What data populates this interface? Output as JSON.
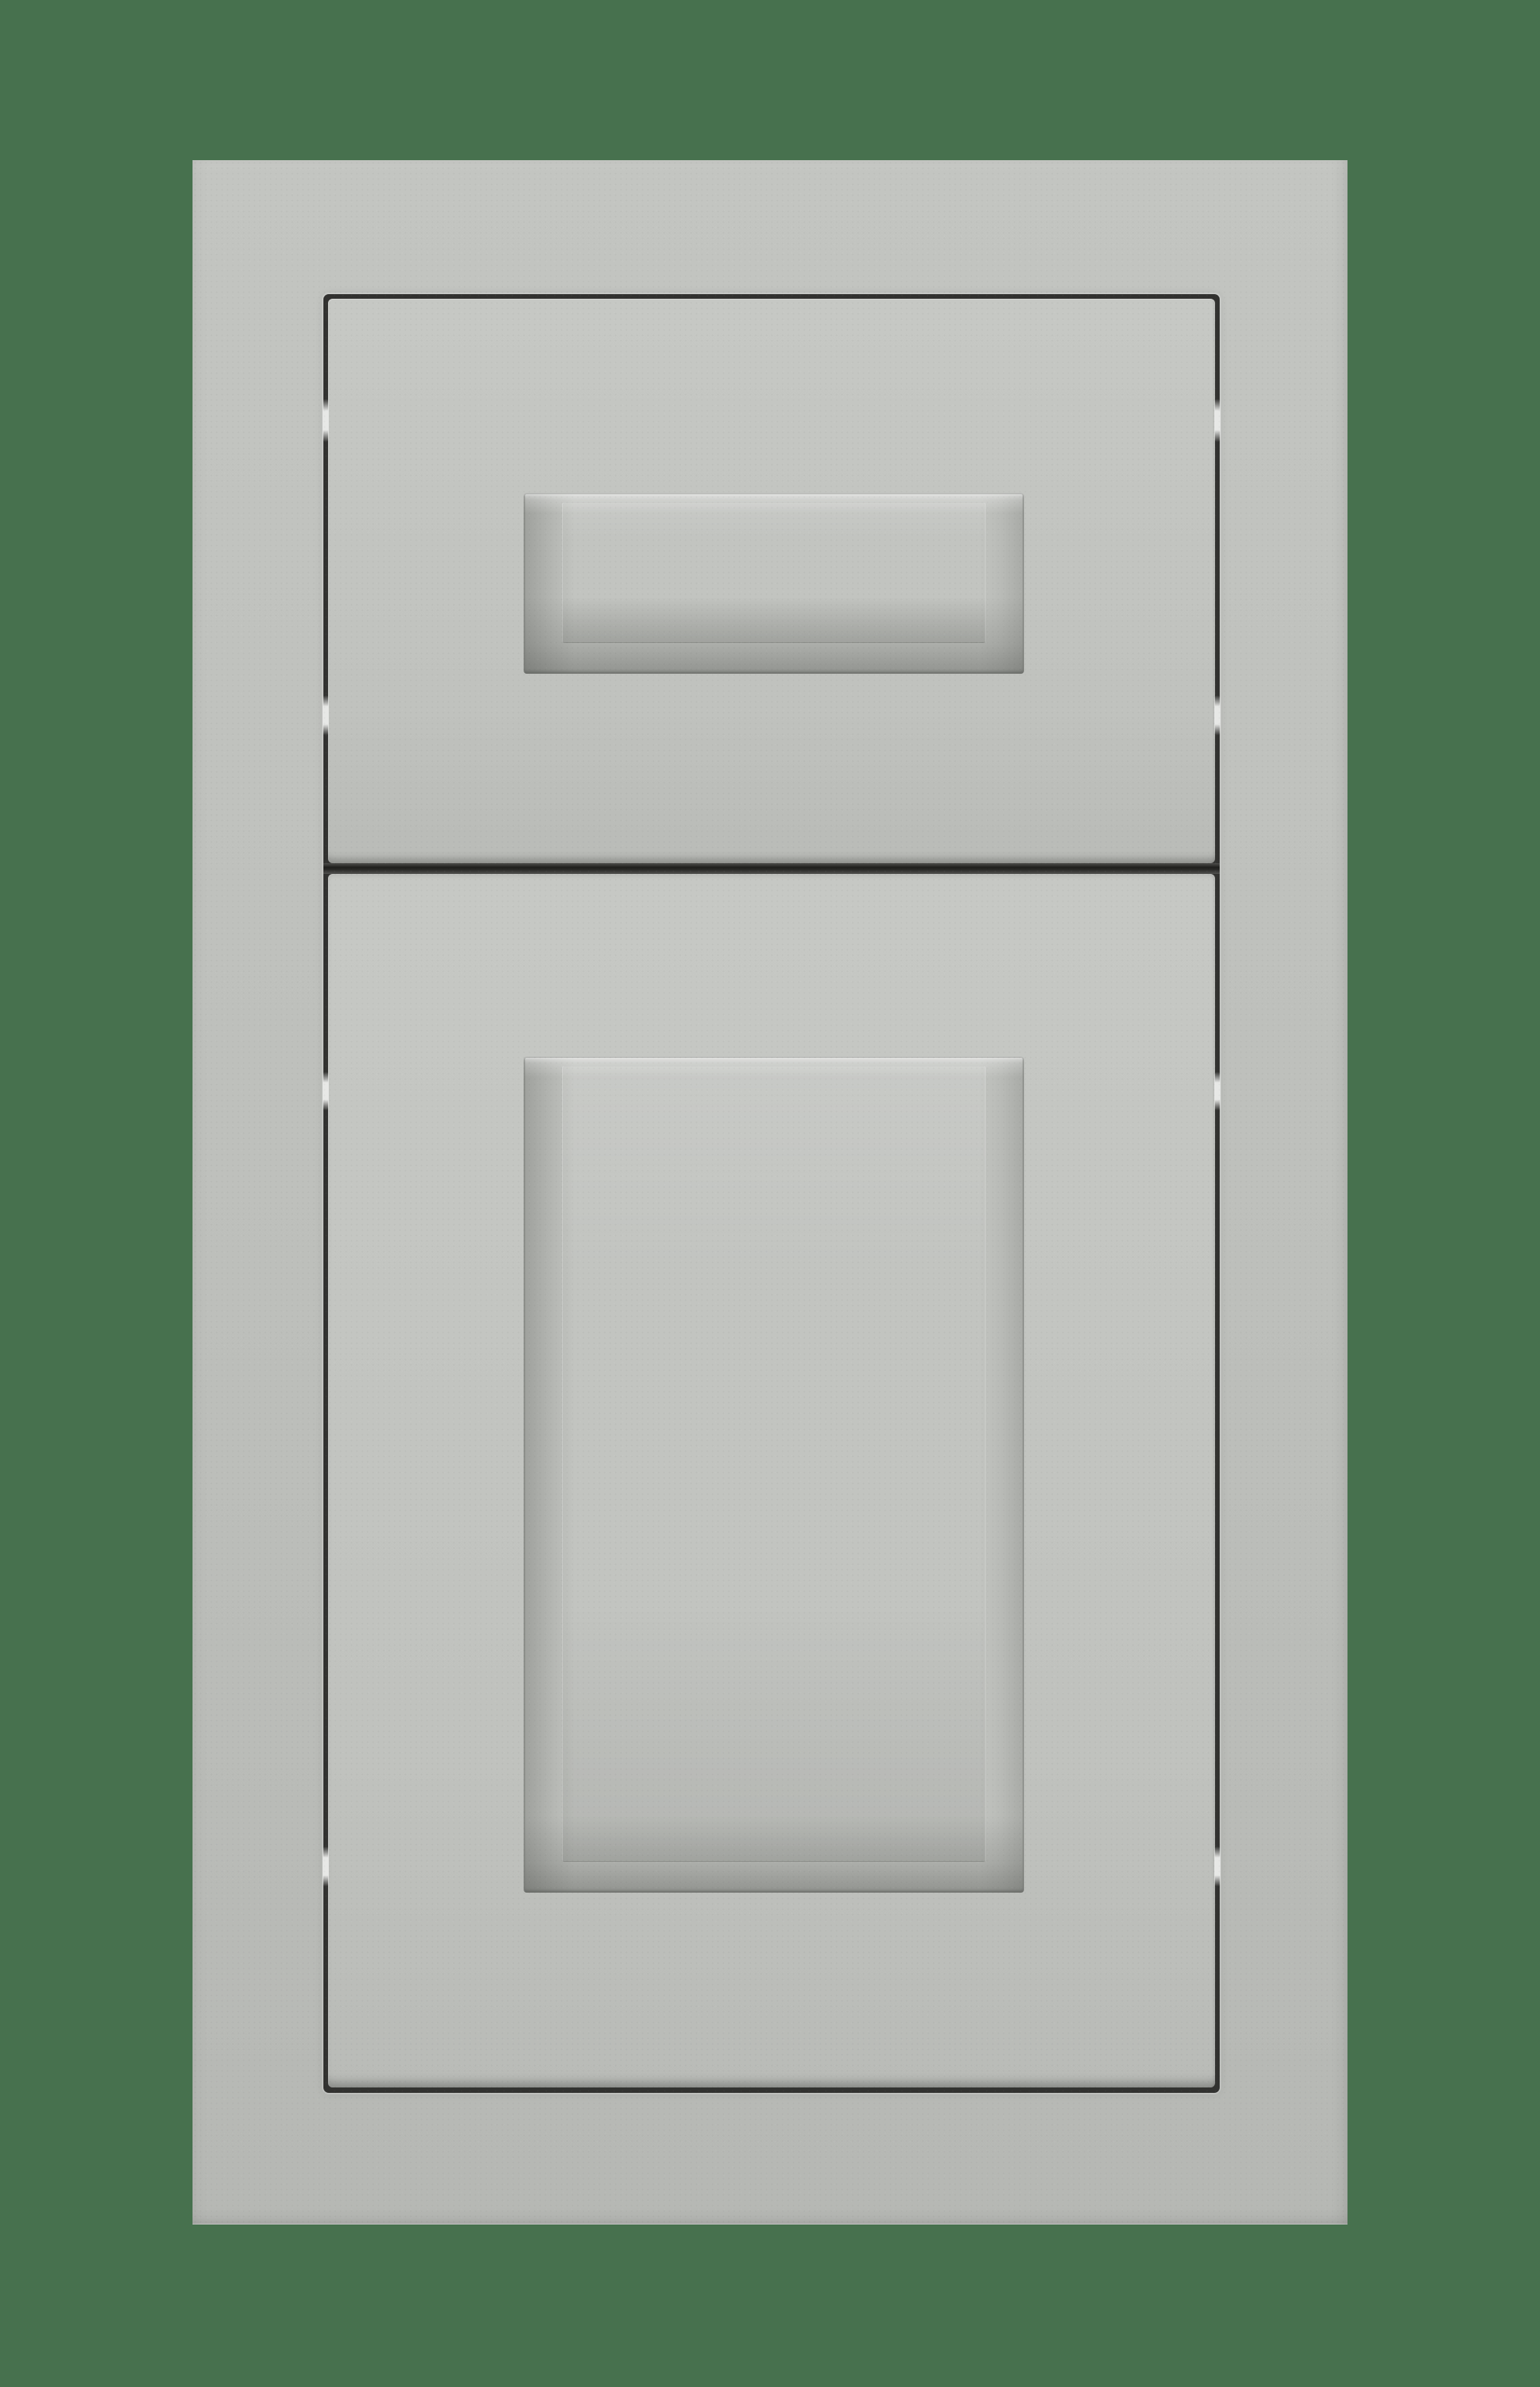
{
  "meta": {
    "subject": "Gray shaker-style cabinet sample: one drawer front above one door front mounted in a face frame, photographed on a plain green background",
    "text_content": "none"
  },
  "parts": [
    {
      "name": "background"
    },
    {
      "name": "cabinet-face-frame"
    },
    {
      "name": "frame-opening-reveal-gap"
    },
    {
      "name": "drawer-front"
    },
    {
      "name": "drawer-recessed-panel"
    },
    {
      "name": "door-front"
    },
    {
      "name": "door-recessed-panel"
    },
    {
      "name": "drawer-door-divider-gap"
    },
    {
      "name": "hinge-gap-highlights"
    }
  ],
  "colors": {
    "background-green": "#47714E",
    "frame-top": "#C3C5C1",
    "frame-mid": "#BDBFBB",
    "frame-bottom": "#B6B8B4",
    "front-top": "#C6C8C4",
    "front-mid": "#C0C2BE",
    "front-bottom": "#B9BBB7",
    "gap-dark": "#323230",
    "gap-deep": "#1E1E1C",
    "hinge-dash": "#E7E8E6",
    "recess-base": "#C2C4C0",
    "recess-highlight": "#D8DAD6",
    "recess-outline": "#6E706C"
  }
}
